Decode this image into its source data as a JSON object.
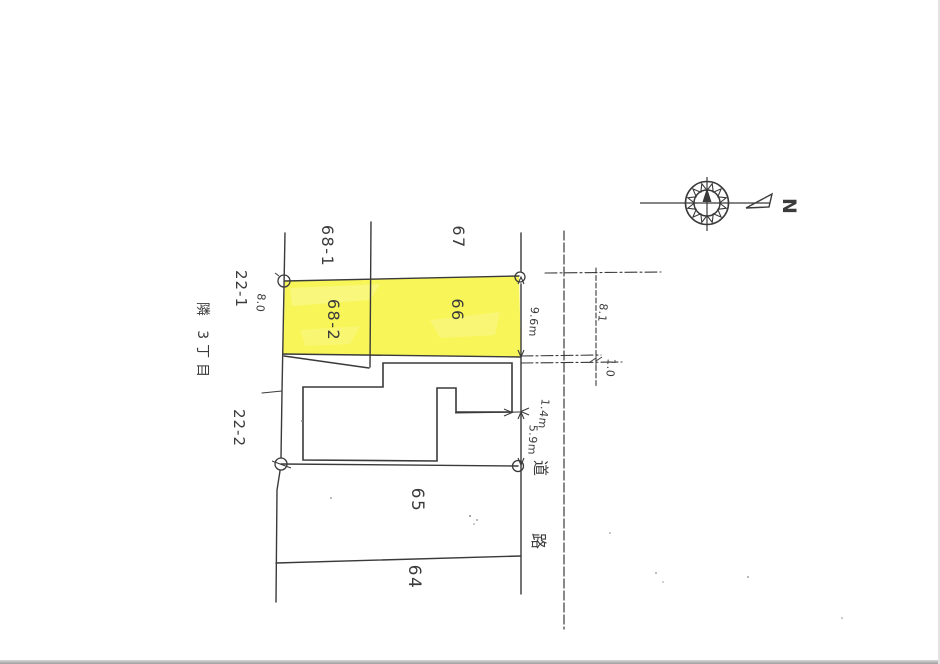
{
  "parcels": {
    "p68_1": "68-1",
    "p67": "67",
    "p68_2": "68-2",
    "p66": "66",
    "p65": "65",
    "p64": "64",
    "p22_1": "22-1",
    "p22_2": "22-2"
  },
  "area_label": "隣 3丁目",
  "road": {
    "label": "道路",
    "kanji_1": "道",
    "kanji_2": "路"
  },
  "measurements": {
    "frontage": "9.6m",
    "side_depth": "5.9m",
    "building_gap": "1.4m",
    "left_width": "8.0",
    "road_dim_upper": "8.1",
    "road_dim_lower": "1.0"
  },
  "compass": {
    "north_label": "N"
  },
  "colors": {
    "highlight": "#f7f33b",
    "line": "#3a3a3a"
  }
}
